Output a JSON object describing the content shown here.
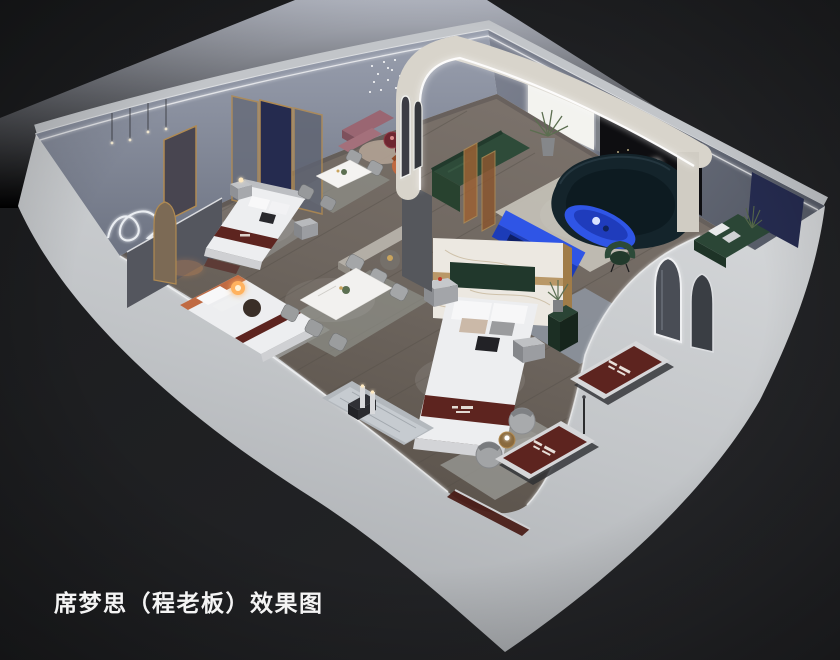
{
  "caption": {
    "text": "席梦思（程老板）效果图"
  },
  "palette": {
    "background_dark": "#1b1c1e",
    "backdrop_gray": "#a2a8b5",
    "wall_outer_light": "#cdd0d3",
    "wall_inner_blue_gray": "#868da0",
    "floor_wood": "#6e665f",
    "arch_cream": "#d8d4cb",
    "led_white": "#ffffff",
    "accent_cobalt": "#2f55e6",
    "accent_cobalt_dark": "#1c3cb8",
    "sofa_green": "#2e4b39",
    "sofa_teal": "#14242b",
    "bench_green": "#2b4636",
    "mattress_maroon": "#5d241f",
    "mattress_silver": "#d6d7d9",
    "bedding_white": "#edeef0",
    "trim_gold": "#b08a52",
    "navy_panel": "#252b4f",
    "mauve_rose": "#9a6672",
    "terracotta": "#c06a42",
    "lamp_amber": "#ffb25e",
    "marble_white": "#ece8e1",
    "feature_wall_black": "#0e0e11",
    "caption_white": "#f4f4f4"
  },
  "scene": {
    "type": "interior-3d-rendering",
    "view": "isometric cutaway (dollhouse) view of a mattress showroom",
    "objects": [
      "cutaway room box with light gray walls",
      "wood showroom floor",
      "display beds with white bedding and maroon brand runners",
      "marble headboard partition with gold trim",
      "two dining table sets with chairs",
      "green modular sofa",
      "dark navy curved sofa",
      "cobalt blue coffee table and media bench",
      "arched cream partition with led strip",
      "two arched led mirrors",
      "mattress floor displays with brand labels",
      "gray swivel barrel chairs",
      "neon squiggle wall light",
      "string light installations",
      "floor lamp with glowing globes",
      "potted plants"
    ]
  }
}
